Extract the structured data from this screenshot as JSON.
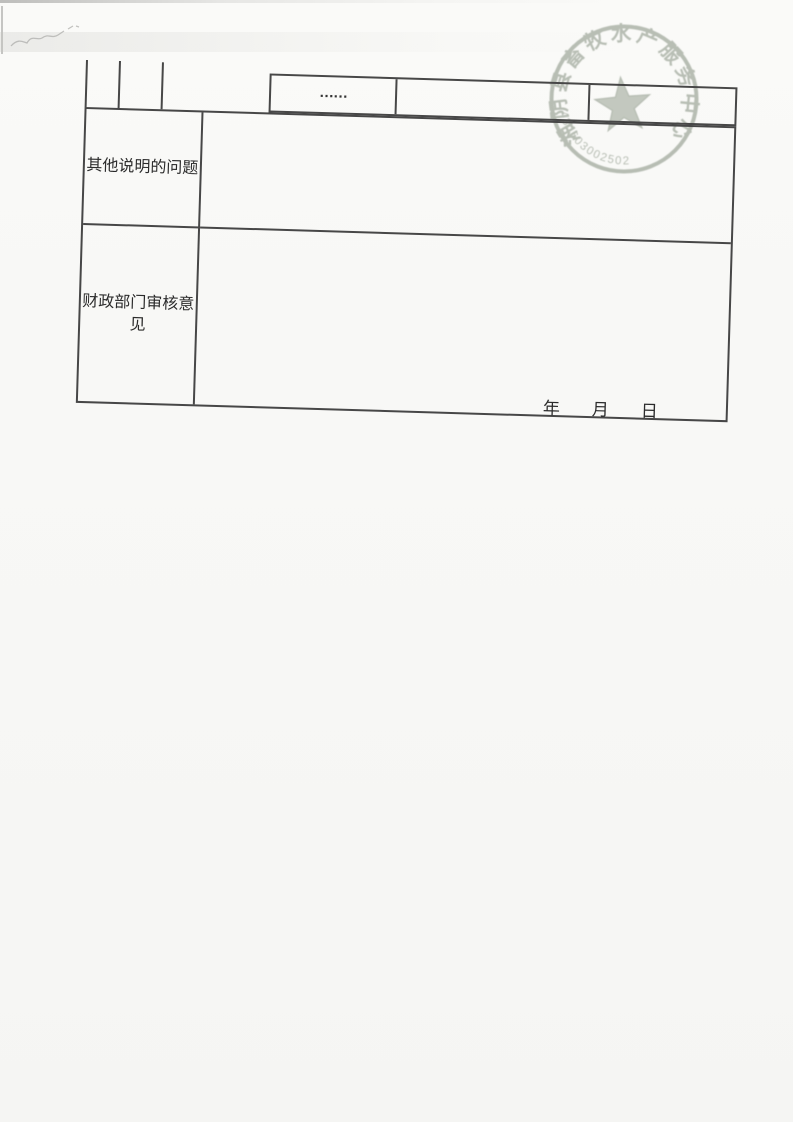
{
  "paper": {
    "background": "#f8f8f6",
    "table_line_color": "#474747",
    "text_color": "#2b2b2b"
  },
  "table": {
    "continuation_ellipsis": "……",
    "rows": [
      {
        "label": "其他说明的问题"
      },
      {
        "label": "财政部门审核意见"
      }
    ],
    "date": {
      "year": "年",
      "month": "月",
      "day": "日"
    }
  },
  "stamp": {
    "arc_text": "湘阴县畜牧水产服务中心",
    "serial_number": "430603002502",
    "ink_color": "#99a294"
  }
}
